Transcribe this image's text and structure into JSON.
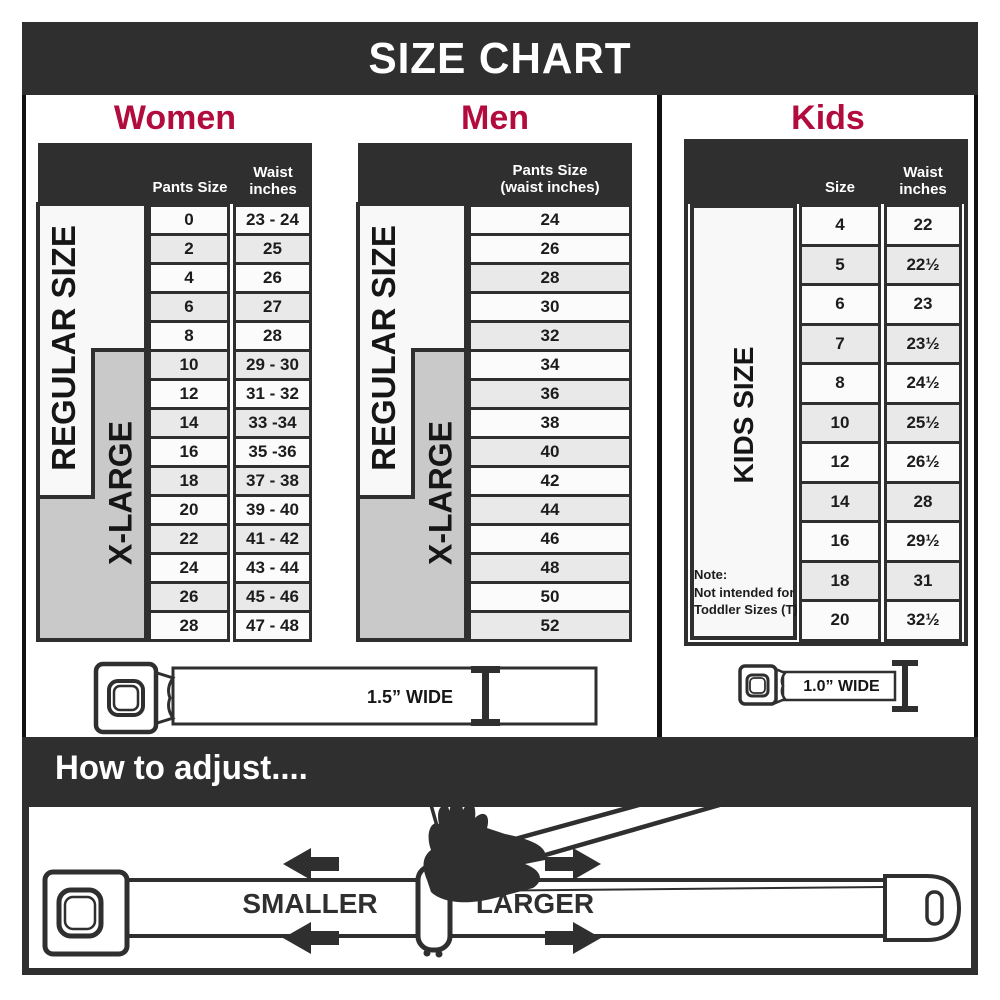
{
  "title": "SIZE CHART",
  "colors": {
    "accent_crimson": "#b20c3f",
    "dark": "#2f2f2f",
    "shaded_row": "#e9e9e9",
    "row": "#fbfbfb",
    "xlarge_gray": "#c9c9c9"
  },
  "sections": {
    "women": {
      "heading": "Women",
      "col1_header": "Pants Size",
      "col2_header": "Waist\ninches",
      "regular_label": "REGULAR SIZE",
      "xlarge_label": "X-LARGE",
      "rows": [
        {
          "size": "0",
          "waist": "23 - 24",
          "shaded": false
        },
        {
          "size": "2",
          "waist": "25",
          "shaded": true
        },
        {
          "size": "4",
          "waist": "26",
          "shaded": false
        },
        {
          "size": "6",
          "waist": "27",
          "shaded": true
        },
        {
          "size": "8",
          "waist": "28",
          "shaded": false
        },
        {
          "size": "10",
          "waist": "29 - 30",
          "shaded": true
        },
        {
          "size": "12",
          "waist": "31 - 32",
          "shaded": false
        },
        {
          "size": "14",
          "waist": "33 -34",
          "shaded": true
        },
        {
          "size": "16",
          "waist": "35 -36",
          "shaded": false
        },
        {
          "size": "18",
          "waist": "37 - 38",
          "shaded": true
        },
        {
          "size": "20",
          "waist": "39 - 40",
          "shaded": false
        },
        {
          "size": "22",
          "waist": "41 - 42",
          "shaded": true
        },
        {
          "size": "24",
          "waist": "43 - 44",
          "shaded": false
        },
        {
          "size": "26",
          "waist": "45 - 46",
          "shaded": true
        },
        {
          "size": "28",
          "waist": "47 - 48",
          "shaded": false
        }
      ]
    },
    "men": {
      "heading": "Men",
      "col_header": "Pants Size\n(waist inches)",
      "regular_label": "REGULAR SIZE",
      "xlarge_label": "X-LARGE",
      "rows": [
        {
          "size": "24",
          "shaded": false
        },
        {
          "size": "26",
          "shaded": false
        },
        {
          "size": "28",
          "shaded": true
        },
        {
          "size": "30",
          "shaded": false
        },
        {
          "size": "32",
          "shaded": true
        },
        {
          "size": "34",
          "shaded": false
        },
        {
          "size": "36",
          "shaded": true
        },
        {
          "size": "38",
          "shaded": false
        },
        {
          "size": "40",
          "shaded": true
        },
        {
          "size": "42",
          "shaded": false
        },
        {
          "size": "44",
          "shaded": true
        },
        {
          "size": "46",
          "shaded": false
        },
        {
          "size": "48",
          "shaded": true
        },
        {
          "size": "50",
          "shaded": false
        },
        {
          "size": "52",
          "shaded": true
        }
      ]
    },
    "kids": {
      "heading": "Kids",
      "col1_header": "Size",
      "col2_header": "Waist\ninches",
      "side_label": "KIDS SIZE",
      "note": "Note:\nNot intended for\nToddler Sizes (T)",
      "rows": [
        {
          "size": "4",
          "waist": "22",
          "shaded": false
        },
        {
          "size": "5",
          "waist": "22½",
          "shaded": true
        },
        {
          "size": "6",
          "waist": "23",
          "shaded": false
        },
        {
          "size": "7",
          "waist": "23½",
          "shaded": true
        },
        {
          "size": "8",
          "waist": "24½",
          "shaded": false
        },
        {
          "size": "10",
          "waist": "25½",
          "shaded": true
        },
        {
          "size": "12",
          "waist": "26½",
          "shaded": false
        },
        {
          "size": "14",
          "waist": "28",
          "shaded": true
        },
        {
          "size": "16",
          "waist": "29½",
          "shaded": false
        },
        {
          "size": "18",
          "waist": "31",
          "shaded": true
        },
        {
          "size": "20",
          "waist": "32½",
          "shaded": false
        }
      ]
    }
  },
  "belts": {
    "adult_width_label": "1.5” WIDE",
    "kids_width_label": "1.0” WIDE"
  },
  "adjust": {
    "heading": "How to adjust....",
    "smaller_label": "SMALLER",
    "larger_label": "LARGER"
  }
}
